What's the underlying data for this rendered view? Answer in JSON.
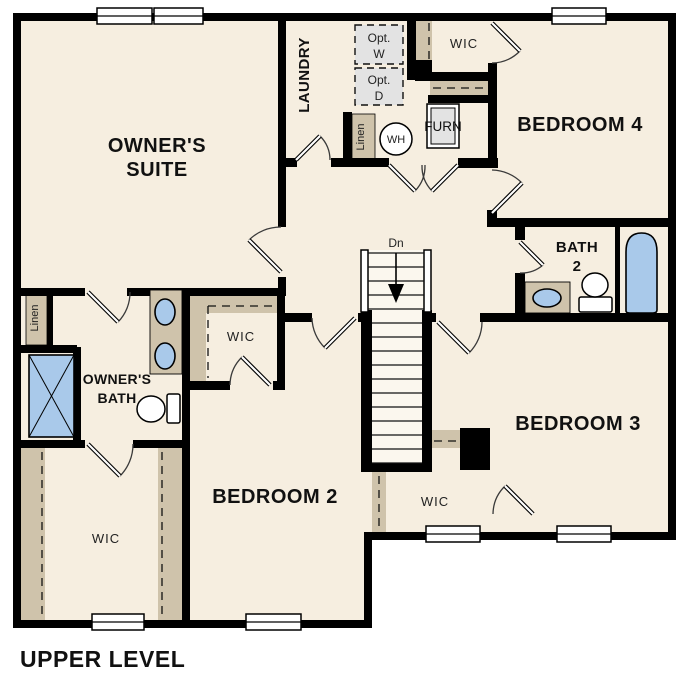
{
  "title": {
    "label": "UPPER LEVEL"
  },
  "colors": {
    "floor": "#f6eee0",
    "wall": "#000000",
    "shelf_tan": "#cfc3ab",
    "fixture_blue": "#a9c9ea",
    "optional_gray": "#e3e3e3",
    "background": "#ffffff"
  },
  "rooms": {
    "owners_suite": {
      "line1": "OWNER'S",
      "line2": "SUITE"
    },
    "laundry": {
      "label": "LAUNDRY"
    },
    "bedroom4": {
      "label": "BEDROOM 4"
    },
    "bath2": {
      "line1": "BATH",
      "line2": "2"
    },
    "bedroom3": {
      "label": "BEDROOM 3"
    },
    "bedroom2": {
      "label": "BEDROOM 2"
    },
    "owners_bath": {
      "line1": "OWNER'S",
      "line2": "BATH"
    },
    "wic_bedroom4": {
      "label": "WIC"
    },
    "wic_middle": {
      "label": "WIC"
    },
    "wic_owners": {
      "label": "WIC"
    },
    "wic_bedroom3": {
      "label": "WIC"
    }
  },
  "features": {
    "stairs_down": "Dn",
    "water_heater": "WH",
    "furnace": "FURN",
    "opt_washer_line1": "Opt.",
    "opt_washer_line2": "W",
    "opt_dryer_line1": "Opt.",
    "opt_dryer_line2": "D",
    "linen_laundry": "Linen",
    "linen_owners": "Linen"
  }
}
